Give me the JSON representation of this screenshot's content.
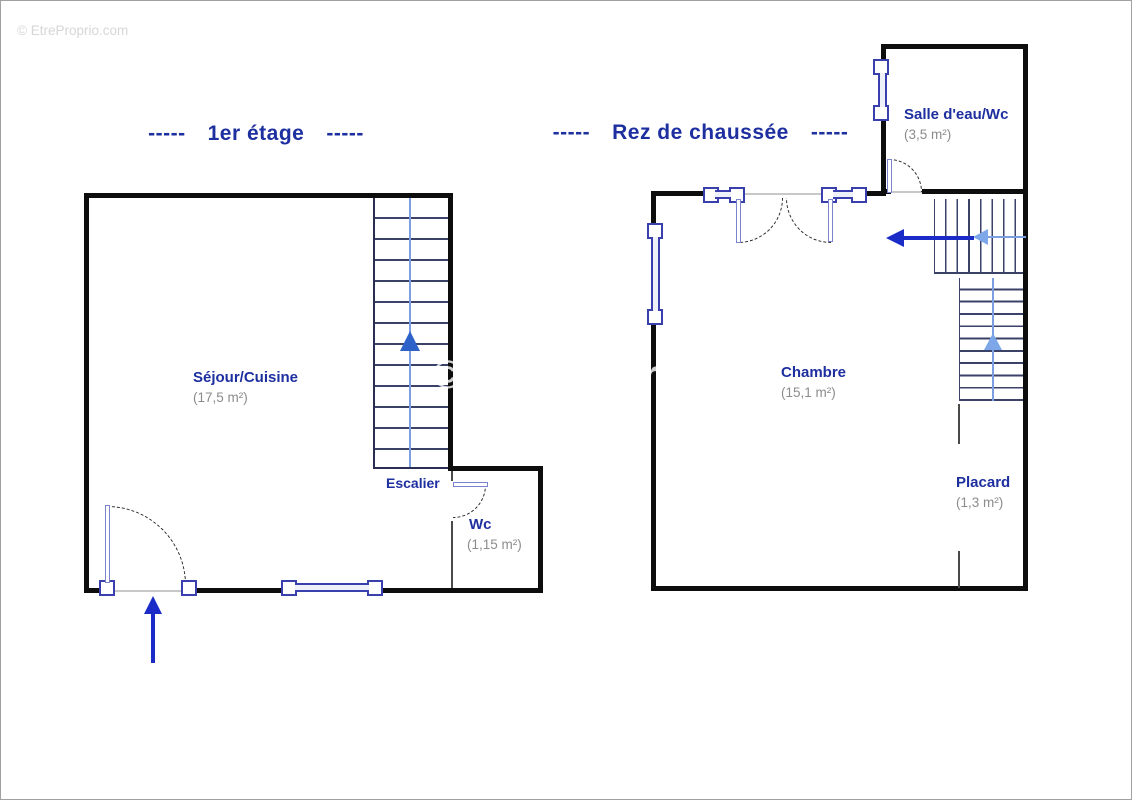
{
  "watermarks": {
    "top_left": "© EtreProprio.com",
    "center": "© EtreProprio"
  },
  "floor_first": {
    "title_dash_left": "-----",
    "title": "1er étage",
    "title_dash_right": "-----",
    "rooms": {
      "sejour_name": "Séjour/Cuisine",
      "sejour_area": "(17,5 m²)",
      "escalier_label": "Escalier",
      "wc_name": "Wc",
      "wc_area": "(1,15 m²)"
    }
  },
  "floor_ground": {
    "title_dash_left": "-----",
    "title": "Rez de chaussée",
    "title_dash_right": "-----",
    "rooms": {
      "chambre_name": "Chambre",
      "chambre_area": "(15,1 m²)",
      "salle_eau_name": "Salle d'eau/Wc",
      "salle_eau_area": "(3,5 m²)",
      "placard_name": "Placard",
      "placard_area": "(1,3 m²)"
    }
  },
  "colors": {
    "label_blue": "#1e2fa0",
    "area_gray": "#8c8c8c",
    "wall_black": "#0d0d0d",
    "arrow_blue": "#1b2bc8",
    "stair_arrow_light": "#7da7e8",
    "window_navy": "#3a3fae"
  }
}
